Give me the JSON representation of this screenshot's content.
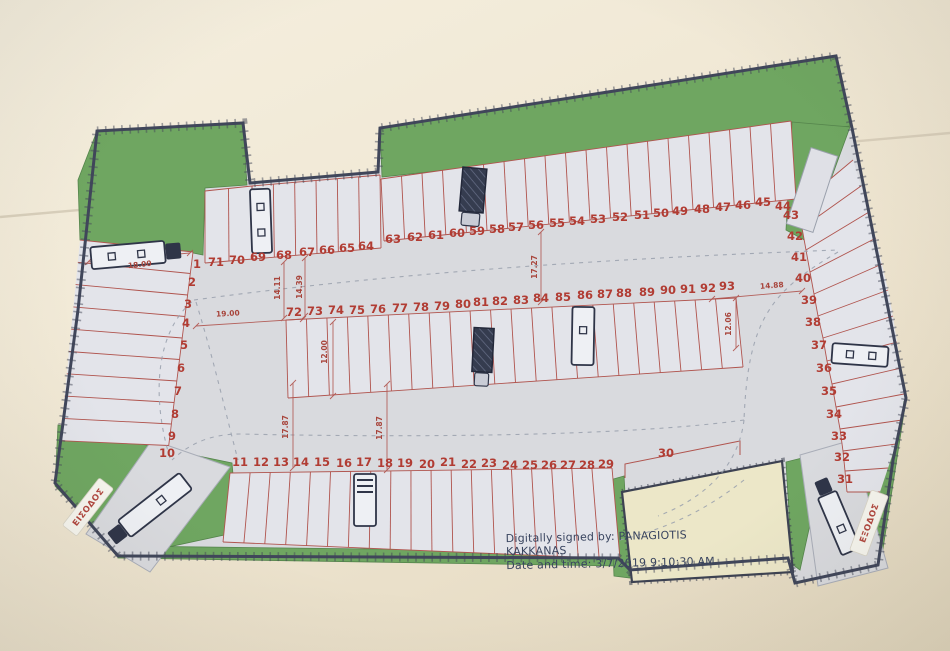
{
  "title": "Parking lot site plan (scanned drawing)",
  "signature": {
    "line1": "Digitally signed by:  PANAGIOTIS",
    "line2": "KAKKANAS",
    "line3": "Date and time: 3/7/2019 9:10:30 AM"
  },
  "labels": {
    "entrance": "ΕΙΣΟΔΟΣ",
    "exit": "ΕΞΟΔΟΣ"
  },
  "colors": {
    "paper_background": "#f1e9d6",
    "pavement": "#d9dade",
    "parking_row_fill": "#e3e4ea",
    "landscape_green": "#6fa661",
    "space_lines_red": "#b0544e",
    "numbers_red": "#b13c33",
    "boundary_dark": "#40465a",
    "neighbor_plot_yellow": "#ece7c8",
    "truck_navy": "#2f3548"
  },
  "spaces": [
    {
      "n": "1",
      "x": 197,
      "y": 268
    },
    {
      "n": "71",
      "x": 216,
      "y": 266
    },
    {
      "n": "70",
      "x": 237,
      "y": 264
    },
    {
      "n": "69",
      "x": 258,
      "y": 261
    },
    {
      "n": "68",
      "x": 284,
      "y": 259
    },
    {
      "n": "67",
      "x": 307,
      "y": 256
    },
    {
      "n": "66",
      "x": 327,
      "y": 254
    },
    {
      "n": "65",
      "x": 347,
      "y": 252
    },
    {
      "n": "64",
      "x": 366,
      "y": 250
    },
    {
      "n": "63",
      "x": 393,
      "y": 243
    },
    {
      "n": "62",
      "x": 415,
      "y": 241
    },
    {
      "n": "61",
      "x": 436,
      "y": 239
    },
    {
      "n": "60",
      "x": 457,
      "y": 237
    },
    {
      "n": "59",
      "x": 477,
      "y": 235
    },
    {
      "n": "58",
      "x": 497,
      "y": 233
    },
    {
      "n": "57",
      "x": 516,
      "y": 231
    },
    {
      "n": "56",
      "x": 536,
      "y": 229
    },
    {
      "n": "55",
      "x": 557,
      "y": 227
    },
    {
      "n": "54",
      "x": 577,
      "y": 225
    },
    {
      "n": "53",
      "x": 598,
      "y": 223
    },
    {
      "n": "52",
      "x": 620,
      "y": 221
    },
    {
      "n": "51",
      "x": 642,
      "y": 219
    },
    {
      "n": "50",
      "x": 661,
      "y": 217
    },
    {
      "n": "49",
      "x": 680,
      "y": 215
    },
    {
      "n": "48",
      "x": 702,
      "y": 213
    },
    {
      "n": "47",
      "x": 723,
      "y": 211
    },
    {
      "n": "46",
      "x": 743,
      "y": 209
    },
    {
      "n": "45",
      "x": 763,
      "y": 206
    },
    {
      "n": "44",
      "x": 783,
      "y": 210
    },
    {
      "n": "43",
      "x": 791,
      "y": 219
    },
    {
      "n": "42",
      "x": 795,
      "y": 240
    },
    {
      "n": "41",
      "x": 799,
      "y": 261
    },
    {
      "n": "40",
      "x": 803,
      "y": 282
    },
    {
      "n": "39",
      "x": 809,
      "y": 304
    },
    {
      "n": "38",
      "x": 813,
      "y": 326
    },
    {
      "n": "37",
      "x": 819,
      "y": 349
    },
    {
      "n": "36",
      "x": 824,
      "y": 372
    },
    {
      "n": "35",
      "x": 829,
      "y": 395
    },
    {
      "n": "34",
      "x": 834,
      "y": 418
    },
    {
      "n": "33",
      "x": 839,
      "y": 440
    },
    {
      "n": "32",
      "x": 842,
      "y": 461
    },
    {
      "n": "31",
      "x": 845,
      "y": 483
    },
    {
      "n": "72",
      "x": 294,
      "y": 316
    },
    {
      "n": "73",
      "x": 315,
      "y": 315
    },
    {
      "n": "74",
      "x": 336,
      "y": 314
    },
    {
      "n": "75",
      "x": 357,
      "y": 314
    },
    {
      "n": "76",
      "x": 378,
      "y": 313
    },
    {
      "n": "77",
      "x": 400,
      "y": 312
    },
    {
      "n": "78",
      "x": 421,
      "y": 311
    },
    {
      "n": "79",
      "x": 442,
      "y": 310
    },
    {
      "n": "80",
      "x": 463,
      "y": 308
    },
    {
      "n": "81",
      "x": 481,
      "y": 306
    },
    {
      "n": "82",
      "x": 500,
      "y": 305
    },
    {
      "n": "83",
      "x": 521,
      "y": 304
    },
    {
      "n": "84",
      "x": 541,
      "y": 302
    },
    {
      "n": "85",
      "x": 563,
      "y": 301
    },
    {
      "n": "86",
      "x": 585,
      "y": 299
    },
    {
      "n": "87",
      "x": 605,
      "y": 298
    },
    {
      "n": "88",
      "x": 624,
      "y": 297
    },
    {
      "n": "89",
      "x": 647,
      "y": 296
    },
    {
      "n": "90",
      "x": 668,
      "y": 294
    },
    {
      "n": "91",
      "x": 688,
      "y": 293
    },
    {
      "n": "92",
      "x": 708,
      "y": 292
    },
    {
      "n": "93",
      "x": 727,
      "y": 290
    },
    {
      "n": "11",
      "x": 240,
      "y": 466
    },
    {
      "n": "12",
      "x": 261,
      "y": 466
    },
    {
      "n": "13",
      "x": 281,
      "y": 466
    },
    {
      "n": "14",
      "x": 301,
      "y": 466
    },
    {
      "n": "15",
      "x": 322,
      "y": 466
    },
    {
      "n": "16",
      "x": 344,
      "y": 467
    },
    {
      "n": "17",
      "x": 364,
      "y": 466
    },
    {
      "n": "18",
      "x": 385,
      "y": 467
    },
    {
      "n": "19",
      "x": 405,
      "y": 467
    },
    {
      "n": "20",
      "x": 427,
      "y": 468
    },
    {
      "n": "21",
      "x": 448,
      "y": 466
    },
    {
      "n": "22",
      "x": 469,
      "y": 468
    },
    {
      "n": "23",
      "x": 489,
      "y": 467
    },
    {
      "n": "24",
      "x": 510,
      "y": 469
    },
    {
      "n": "25",
      "x": 530,
      "y": 469
    },
    {
      "n": "26",
      "x": 549,
      "y": 469
    },
    {
      "n": "27",
      "x": 568,
      "y": 469
    },
    {
      "n": "28",
      "x": 587,
      "y": 469
    },
    {
      "n": "29",
      "x": 606,
      "y": 468
    },
    {
      "n": "30",
      "x": 666,
      "y": 457
    },
    {
      "n": "2",
      "x": 192,
      "y": 286
    },
    {
      "n": "3",
      "x": 188,
      "y": 308
    },
    {
      "n": "4",
      "x": 186,
      "y": 327
    },
    {
      "n": "5",
      "x": 184,
      "y": 349
    },
    {
      "n": "6",
      "x": 181,
      "y": 372
    },
    {
      "n": "7",
      "x": 178,
      "y": 395
    },
    {
      "n": "8",
      "x": 175,
      "y": 418
    },
    {
      "n": "9",
      "x": 172,
      "y": 440
    },
    {
      "n": "10",
      "x": 167,
      "y": 457
    }
  ],
  "dimensions": [
    {
      "text": "18.00",
      "x": 140,
      "y": 267,
      "rot": -6
    },
    {
      "text": "19.00",
      "x": 228,
      "y": 316,
      "rot": -3
    },
    {
      "text": "14.11",
      "x": 280,
      "y": 288,
      "rot": -90
    },
    {
      "text": "14.39",
      "x": 302,
      "y": 287,
      "rot": -90
    },
    {
      "text": "12.00",
      "x": 327,
      "y": 352,
      "rot": -90
    },
    {
      "text": "17.27",
      "x": 537,
      "y": 267,
      "rot": -90
    },
    {
      "text": "17.87",
      "x": 288,
      "y": 427,
      "rot": -90
    },
    {
      "text": "17.87",
      "x": 382,
      "y": 428,
      "rot": -90
    },
    {
      "text": "14.88",
      "x": 772,
      "y": 288,
      "rot": -4
    },
    {
      "text": "12.06",
      "x": 731,
      "y": 324,
      "rot": -90
    }
  ],
  "trucks": [
    {
      "name": "truck-space-1",
      "style": "light",
      "cab": true,
      "sq": 2,
      "cx": 128,
      "cy": 255,
      "len": 74,
      "wid": 22,
      "rot": -5
    },
    {
      "name": "truck-space-69",
      "style": "light",
      "cab": false,
      "sq": 2,
      "cx": 261,
      "cy": 221,
      "len": 64,
      "wid": 20,
      "rot": 88
    },
    {
      "name": "truck-space-59",
      "style": "dark",
      "cab": true,
      "cx": 473,
      "cy": 190,
      "len": 44,
      "wid": 24,
      "rot": 95
    },
    {
      "name": "truck-space-81",
      "style": "dark",
      "cab": true,
      "cx": 483,
      "cy": 350,
      "len": 44,
      "wid": 20,
      "rot": 93
    },
    {
      "name": "truck-space-86",
      "style": "light",
      "cab": false,
      "sq": 1,
      "cx": 583,
      "cy": 336,
      "len": 58,
      "wid": 22,
      "rot": 91
    },
    {
      "name": "truck-space-17",
      "style": "front",
      "cab": false,
      "sq": 0,
      "cx": 365,
      "cy": 500,
      "len": 52,
      "wid": 22,
      "rot": 90
    },
    {
      "name": "truck-space-36",
      "style": "light",
      "cab": false,
      "sq": 2,
      "cx": 860,
      "cy": 355,
      "len": 56,
      "wid": 20,
      "rot": 184
    },
    {
      "name": "truck-entrance",
      "style": "light",
      "cab": true,
      "sq": 1,
      "cx": 155,
      "cy": 505,
      "len": 78,
      "wid": 21,
      "rot": 142
    },
    {
      "name": "truck-exit",
      "style": "light",
      "cab": true,
      "sq": 1,
      "cx": 839,
      "cy": 523,
      "len": 62,
      "wid": 20,
      "rot": -113
    }
  ]
}
